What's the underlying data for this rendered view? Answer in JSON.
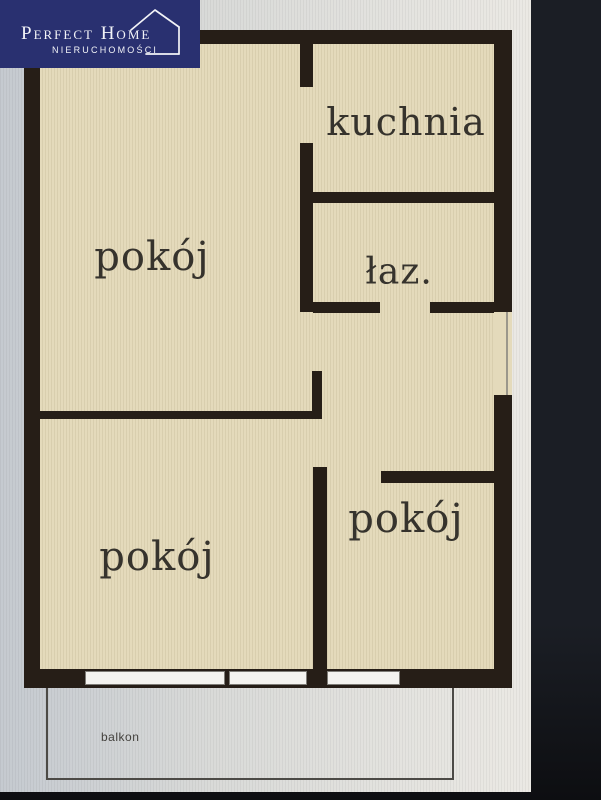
{
  "logo": {
    "brand": "Perfect Home",
    "subtitle": "NIERUCHOMOŚCI"
  },
  "plan": {
    "labels": {
      "kitchen": "kuchnia",
      "bathroom": "łaz.",
      "room_top_left": "pokój",
      "room_bottom_left": "pokój",
      "room_bottom_right": "pokój",
      "balcony": "balkon"
    }
  },
  "colors": {
    "logo_bg": "#293070",
    "logo_text": "#f2f3f7",
    "wall": "#261e17",
    "floor": "#e4dabb",
    "paper_left": "#c5cad0",
    "paper_right": "#ebe9e4",
    "backdrop": "#1b1e25",
    "backdrop_bottom": "#0d0e11",
    "window": "#f4f3ef",
    "balcony_line": "#4c4a46",
    "label_text": "#36332d"
  }
}
